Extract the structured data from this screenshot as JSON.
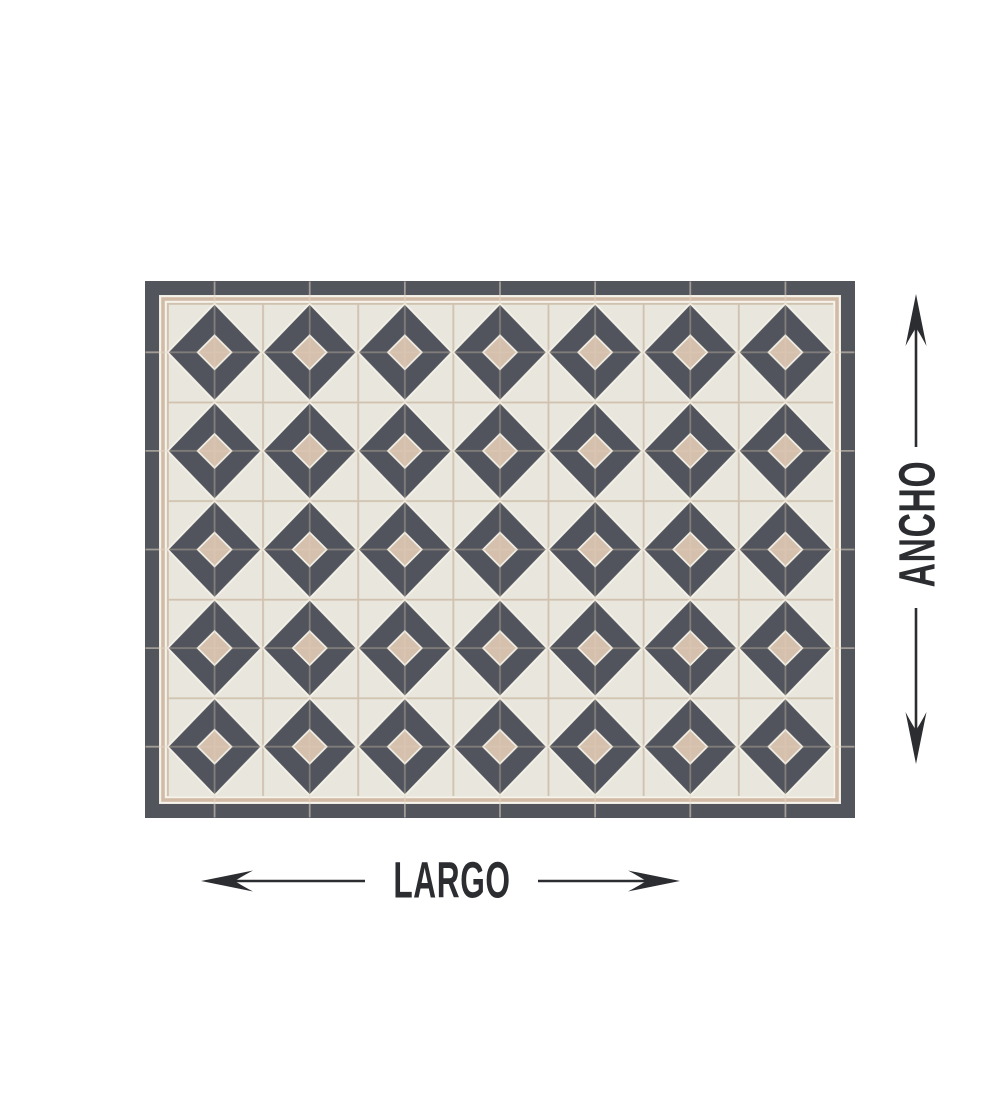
{
  "colors": {
    "page_bg": "#ffffff",
    "frame_dark": "#53555d",
    "tile_dark": "#51545c",
    "cream": "#e9e6dd",
    "beige": "#d5c0ad",
    "pinstripe": "#d2bba6",
    "seam": "#c9bdac",
    "outline_white": "#f5f3ea",
    "ink": "#2b2d30"
  },
  "diagram": {
    "largo_label": "LARGO",
    "ancho_label": "ANCHO",
    "rug": {
      "motif_columns": 7,
      "motif_rows": 5
    }
  }
}
